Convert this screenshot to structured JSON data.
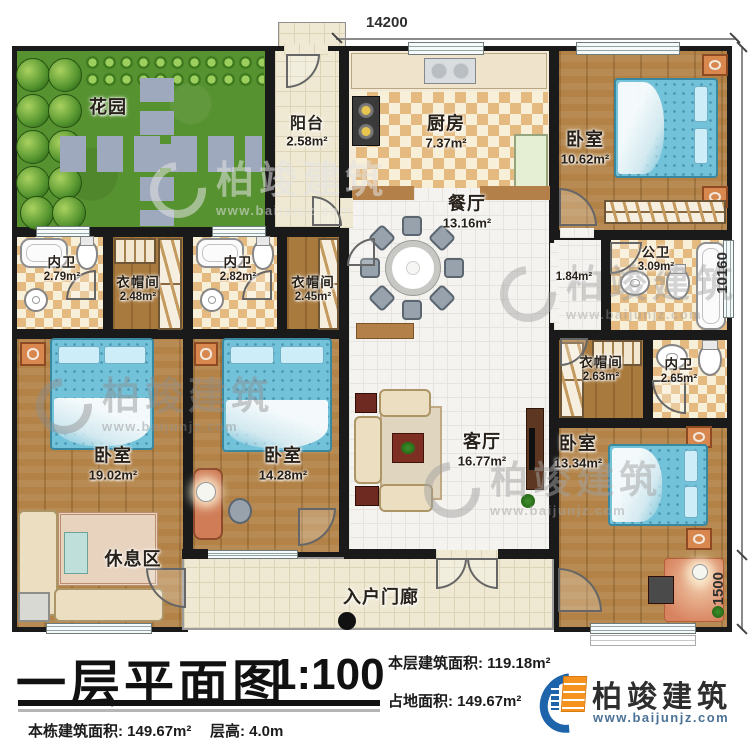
{
  "dimensions": {
    "top": "14200",
    "right": "10160",
    "right_lower": "1500"
  },
  "rooms": {
    "garden": {
      "name": "花园"
    },
    "balcony": {
      "name": "阳台",
      "area": "2.58m²"
    },
    "kitchen": {
      "name": "厨房",
      "area": "7.37m²"
    },
    "bedroom_tr": {
      "name": "卧室",
      "area": "10.62m²"
    },
    "dining": {
      "name": "餐厅",
      "area": "13.16m²"
    },
    "bath_left_1": {
      "name": "内卫",
      "area": "2.79m²"
    },
    "cloak_left_1": {
      "name": "衣帽间",
      "area": "2.48m²"
    },
    "bath_left_2": {
      "name": "内卫",
      "area": "2.82m²"
    },
    "cloak_left_2": {
      "name": "衣帽间",
      "area": "2.45m²"
    },
    "public_bath": {
      "name": "公卫",
      "area": "3.09m²"
    },
    "hallway": {
      "area": "1.84m²"
    },
    "cloak_right": {
      "name": "衣帽间",
      "area": "2.63m²"
    },
    "bath_right": {
      "name": "内卫",
      "area": "2.65m²"
    },
    "bedroom_left": {
      "name": "卧室",
      "area": "19.02m²"
    },
    "rest_area": {
      "name": "休息区"
    },
    "bedroom_mid": {
      "name": "卧室",
      "area": "14.28m²"
    },
    "living": {
      "name": "客厅",
      "area": "16.77m²"
    },
    "bedroom_br": {
      "name": "卧室",
      "area": "13.34m²"
    },
    "porch": {
      "name": "入户门廊"
    }
  },
  "title_block": {
    "title": "一层平面图",
    "scale": "1:100",
    "floor_area_label": "本层建筑面积:",
    "floor_area_value": "119.18m²",
    "land_area_label": "占地面积:",
    "land_area_value": "149.67m²",
    "building_area_label": "本栋建筑面积:",
    "building_area_value": "149.67m²",
    "floor_height_label": "层高:",
    "floor_height_value": "4.0m"
  },
  "brand": {
    "name": "柏竣建筑",
    "url": "www.baijunjz.com"
  },
  "watermark": {
    "name": "柏竣建筑",
    "url": "www.baijunjz.com"
  },
  "colors": {
    "wall": "#1a1a1a",
    "wood": "#b28246",
    "bed": "#72c2da",
    "grass": "#579231",
    "checker_tile": "#e5ba80",
    "brand_blue": "#1d64ab",
    "brand_orange": "#f6921e"
  }
}
